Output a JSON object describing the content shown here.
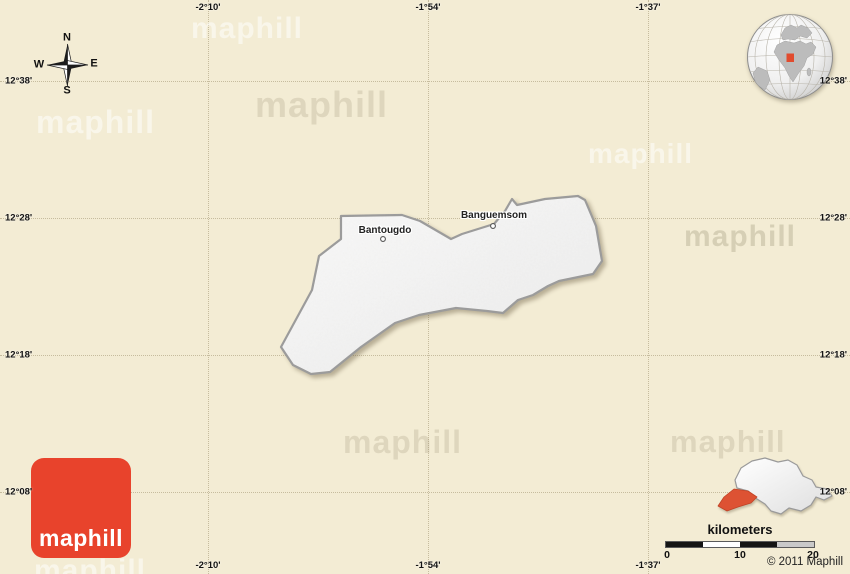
{
  "page": {
    "bg_color": "#f3ecd4",
    "grid_color": "#c6bc9e",
    "watermark_text": "maphill"
  },
  "grid": {
    "meridians": [
      {
        "label": "-2°10'",
        "x": 208
      },
      {
        "label": "-1°54'",
        "x": 428
      },
      {
        "label": "-1°37'",
        "x": 648
      }
    ],
    "parallels": [
      {
        "label": "12°38'",
        "y": 81
      },
      {
        "label": "12°28'",
        "y": 218
      },
      {
        "label": "12°18'",
        "y": 355
      },
      {
        "label": "12°08'",
        "y": 492
      }
    ]
  },
  "compass": {
    "north": "N",
    "south": "S",
    "east": "E",
    "west": "W"
  },
  "region": {
    "fill": "#f4f4f4",
    "stroke": "#9a9a9a",
    "places": [
      {
        "name": "Bantougdo"
      },
      {
        "name": "Banguemsom"
      }
    ]
  },
  "locator": {
    "marker_color": "#e14b2e"
  },
  "thumbnail": {
    "highlight_color": "#dd5233"
  },
  "logo": {
    "text": "maphill",
    "color": "#e8432c"
  },
  "scale": {
    "title": "kilometers",
    "ticks": [
      "0",
      "10",
      "20"
    ]
  },
  "copyright": "© 2011 Maphill"
}
